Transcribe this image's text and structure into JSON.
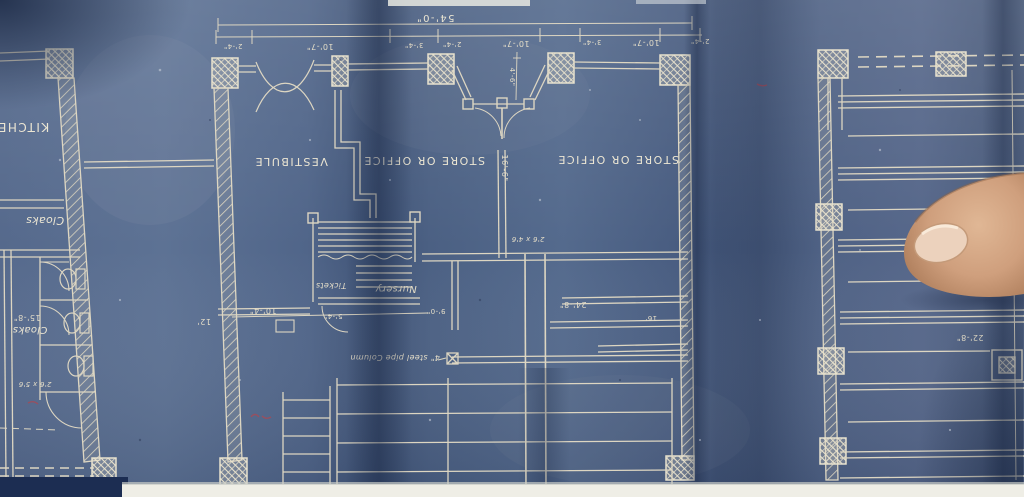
{
  "photo": {
    "subject": "blueprint-floor-plan-photographed-upside-down",
    "colors": {
      "paper_blue": "#51658a",
      "line_cream": "#e6e0cc",
      "fold_shadow": "#2c3c5e",
      "table_white": "#efeee6",
      "edge_navy": "#1c2d52",
      "finger_skin": "#cf9f7d",
      "finger_nail": "#ecd2bd",
      "red_mark": "#a84a55"
    }
  },
  "labels": {
    "kitchen": "KITCHEN",
    "cloaks_upper": "Cloaks",
    "cloaks_lower": "Cloaks",
    "vestibule": "VESTIBULE",
    "store_left": "STORE OR OFFICE",
    "store_right": "STORE OR OFFICE",
    "tickets": "Tickets",
    "nursery": "Nursery",
    "pipe_note": "4\" steel pipe Column",
    "size_note": "2'6 x 4'6",
    "cloak_note": "2'6 x 5'6"
  },
  "dims": {
    "overall": "54'-0\"",
    "seg": [
      "2'-4\"",
      "10'-7\"",
      "3'-4\"",
      "2'-4\"",
      "10'-7\"",
      "3'-4\"",
      "10'-7\"",
      "2'-4\""
    ],
    "v4_6": "4'-6\"",
    "v16_6": "16'-6\"",
    "d15_8": "15'-8\"",
    "d10_4": "10'-4\"",
    "d12": "12'",
    "d5_4": "5'-4\"",
    "d9_0": "9'-0\"",
    "d24_8": "24'-8\"",
    "d16": "16'",
    "d22_8": "22'-8\""
  }
}
